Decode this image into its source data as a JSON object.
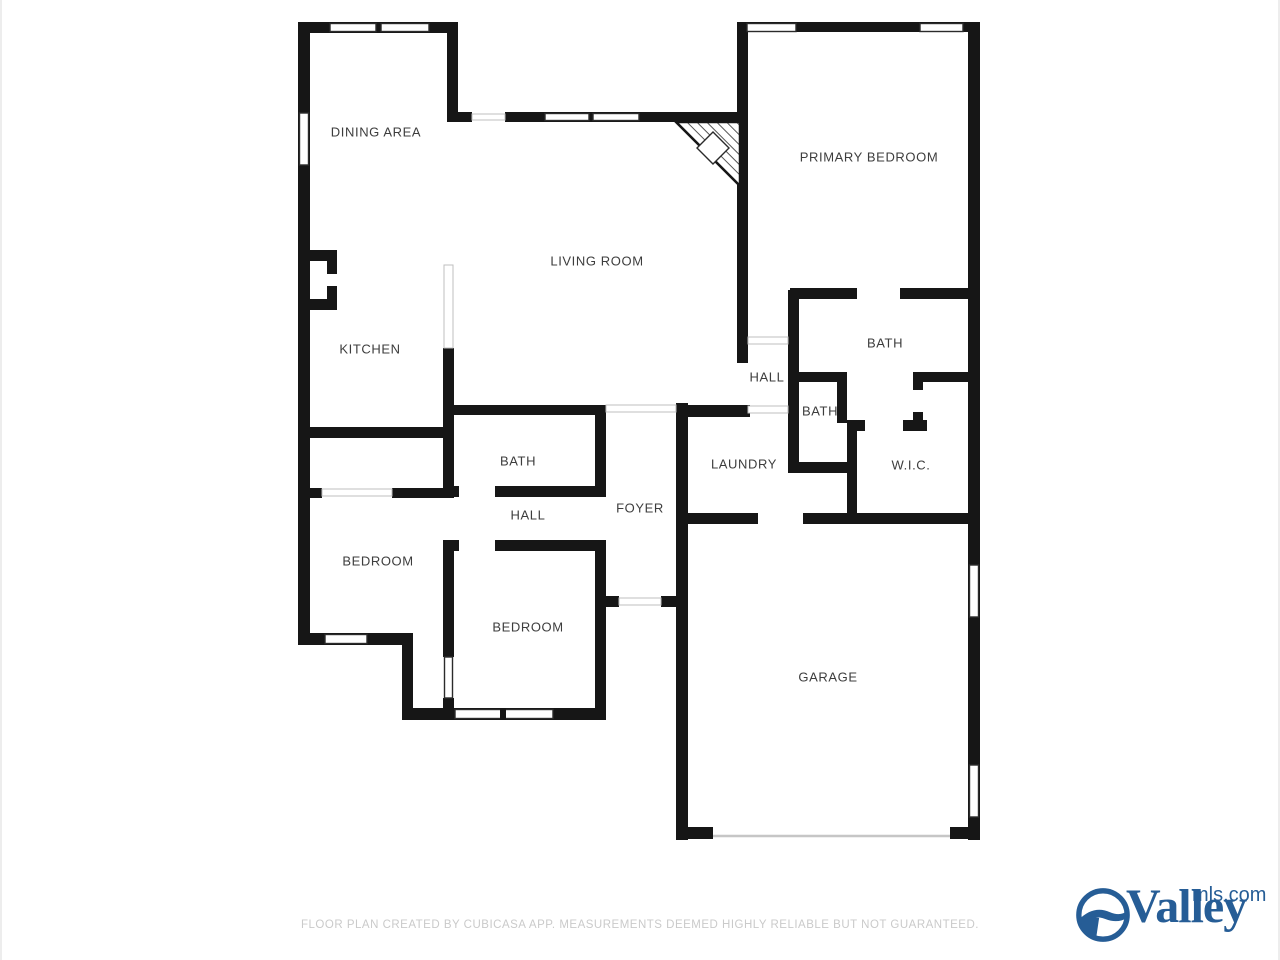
{
  "floorplan": {
    "rooms": [
      {
        "id": "dining-area",
        "label": "DINING AREA",
        "x": 376,
        "y": 132
      },
      {
        "id": "living-room",
        "label": "LIVING ROOM",
        "x": 597,
        "y": 261
      },
      {
        "id": "primary-bedroom",
        "label": "PRIMARY BEDROOM",
        "x": 869,
        "y": 157
      },
      {
        "id": "kitchen",
        "label": "KITCHEN",
        "x": 370,
        "y": 349
      },
      {
        "id": "hall-upper",
        "label": "HALL",
        "x": 767,
        "y": 377
      },
      {
        "id": "bath-primary",
        "label": "BATH",
        "x": 885,
        "y": 343
      },
      {
        "id": "bath-hall",
        "label": "BATH",
        "x": 820,
        "y": 411
      },
      {
        "id": "laundry",
        "label": "LAUNDRY",
        "x": 744,
        "y": 464
      },
      {
        "id": "wic",
        "label": "W.I.C.",
        "x": 911,
        "y": 465
      },
      {
        "id": "foyer",
        "label": "FOYER",
        "x": 640,
        "y": 508
      },
      {
        "id": "bath-small",
        "label": "BATH",
        "x": 518,
        "y": 461
      },
      {
        "id": "hall-lower",
        "label": "HALL",
        "x": 528,
        "y": 515
      },
      {
        "id": "bedroom-left",
        "label": "BEDROOM",
        "x": 378,
        "y": 561
      },
      {
        "id": "bedroom-bottom",
        "label": "BEDROOM",
        "x": 528,
        "y": 627
      },
      {
        "id": "garage",
        "label": "GARAGE",
        "x": 828,
        "y": 677
      }
    ]
  },
  "footer": {
    "disclaimer": "FLOOR PLAN CREATED BY CUBICASA APP. MEASUREMENTS DEEMED HIGHLY RELIABLE BUT NOT GUARANTEED."
  },
  "logo": {
    "brand": "Valley",
    "domain": "mls.com",
    "color": "#265d96"
  },
  "colors": {
    "wall": "#161616",
    "room_label": "#3d3d3d",
    "disclaimer_text": "#cacaca",
    "background": "#ffffff"
  }
}
